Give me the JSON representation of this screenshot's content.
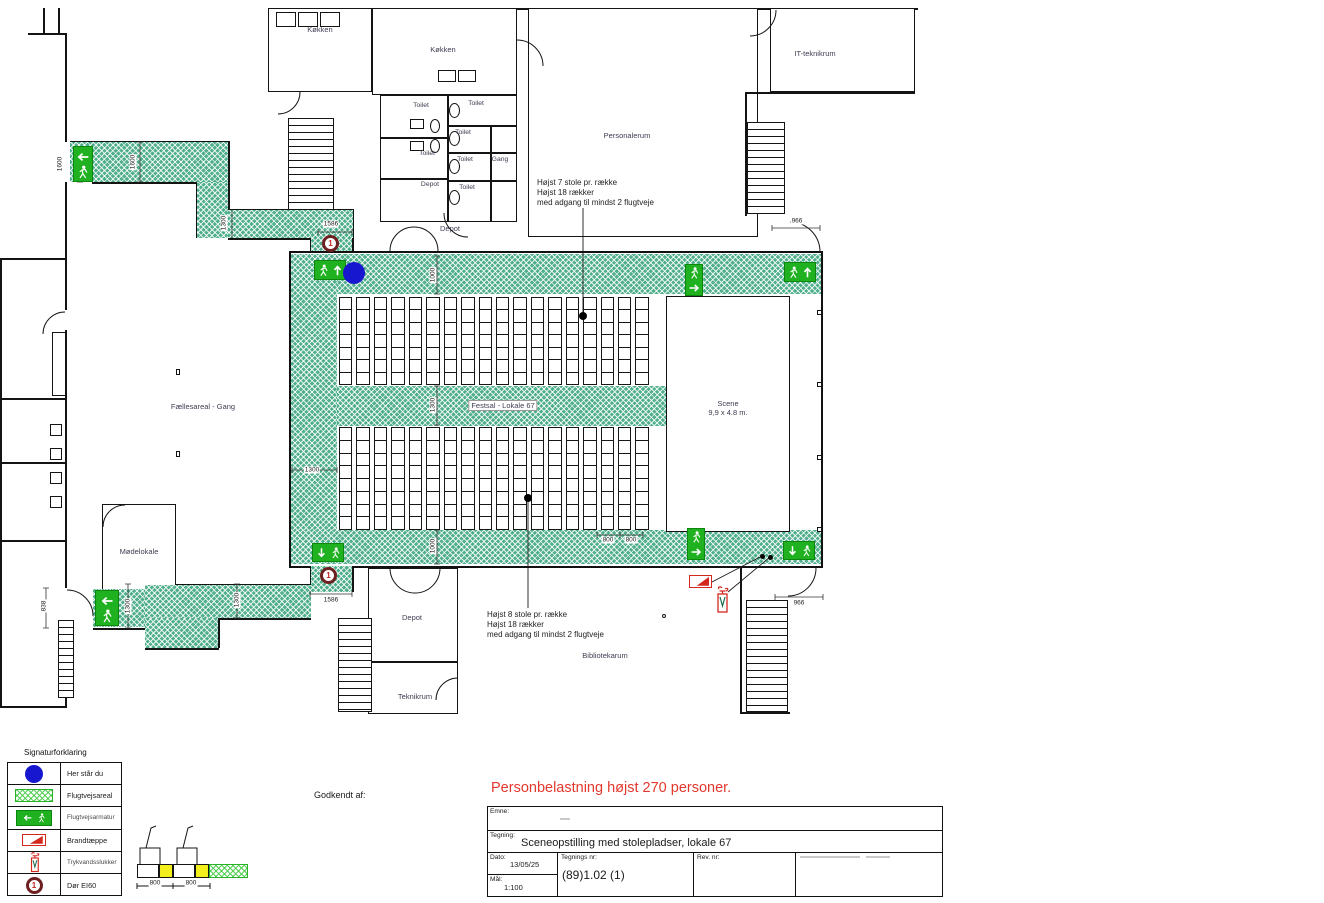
{
  "plan": {
    "rooms": {
      "kitchen_a": "Køkken",
      "kitchen_b": "Køkken",
      "toilet_a": "Toilet",
      "toilet_b": "Toilet",
      "toilet_c": "Toilet",
      "toilet_d": "Toilet",
      "toilet_e": "Toilet",
      "toilet_f": "Toilet",
      "gang": "Gang",
      "depot_toilet": "Depot",
      "depot_top": "Depot",
      "personalerum": "Personalerum",
      "it_room": "IT-teknikrum",
      "faellesareal": "Fællesareal - Gang",
      "moedelokale": "Mødelokale",
      "festsal": "Festsal - Lokale 67",
      "scene_name": "Scene",
      "scene_size": "9,9 x 4.8 m.",
      "depot_bottom": "Depot",
      "teknikrum": "Teknikrum",
      "bibliotekarum": "Bibliotekarum"
    },
    "annotations": {
      "upper": [
        "Højst  7 stole pr. række",
        "Højst 18 rækker",
        "med adgang til mindst 2 flugtveje"
      ],
      "lower": [
        "Højst  8 stole pr. række",
        "Højst 18 rækker",
        "med adgang til mindst 2 flugtveje"
      ]
    },
    "door_marker": "1",
    "dimensions": {
      "tl_1600_a": "1600",
      "tl_1600_b": "1600",
      "tl_1300": "1300",
      "tl_1586": "1586",
      "hall_top_1000": "1000",
      "hall_mid_1300": "1300",
      "hall_left_1300": "1300",
      "hall_bottom_1000": "1000",
      "seat_800_a": "800",
      "seat_800_b": "800",
      "tr_966": "966",
      "br_966": "966",
      "bl_1586": "1586",
      "bl_1300_a": "1300",
      "bl_1300_b": "1300",
      "bl_838": "838"
    },
    "seating": {
      "upper": {
        "columns": 18,
        "rows": 7
      },
      "lower": {
        "columns": 18,
        "rows": 8
      }
    }
  },
  "legend": {
    "title": "Signaturforklaring",
    "items": [
      {
        "icon": "you-are-here-dot",
        "label": "Her står du"
      },
      {
        "icon": "escape-route-area",
        "label": "Flugtvejsareal"
      },
      {
        "icon": "exit-sign",
        "label": "Flugtvejsarmatur"
      },
      {
        "icon": "fire-blanket",
        "label": "Brandtæppe"
      },
      {
        "icon": "water-extinguisher",
        "label": "Trykvandsslukker"
      },
      {
        "icon": "door-ei60",
        "label": "Dør EI60"
      }
    ],
    "detail_dims": {
      "a": "800",
      "b": "800"
    }
  },
  "title_block": {
    "warning": "Personbelastning højst 270 personer.",
    "approved_label": "Godkendt af:",
    "emne_label": "Emne:",
    "tegning_label": "Tegning:",
    "tegning_value": "Sceneopstilling med stolepladser, lokale 67",
    "dato_label": "Dato:",
    "dato_value": "13/05/25",
    "maal_label": "Mål:",
    "maal_value": "1:100",
    "tegnings_nr_label": "Tegnings nr:",
    "tegnings_nr_value": "(89)1.02 (1)",
    "rev_label": "Rev. nr:"
  },
  "colors": {
    "escape_green": "#4fae8b",
    "exit_sign_green": "#1fb11f",
    "you_are_here_blue": "#1717cf",
    "warning_red": "#e2382d",
    "door_marker_red": "#6e2020"
  }
}
